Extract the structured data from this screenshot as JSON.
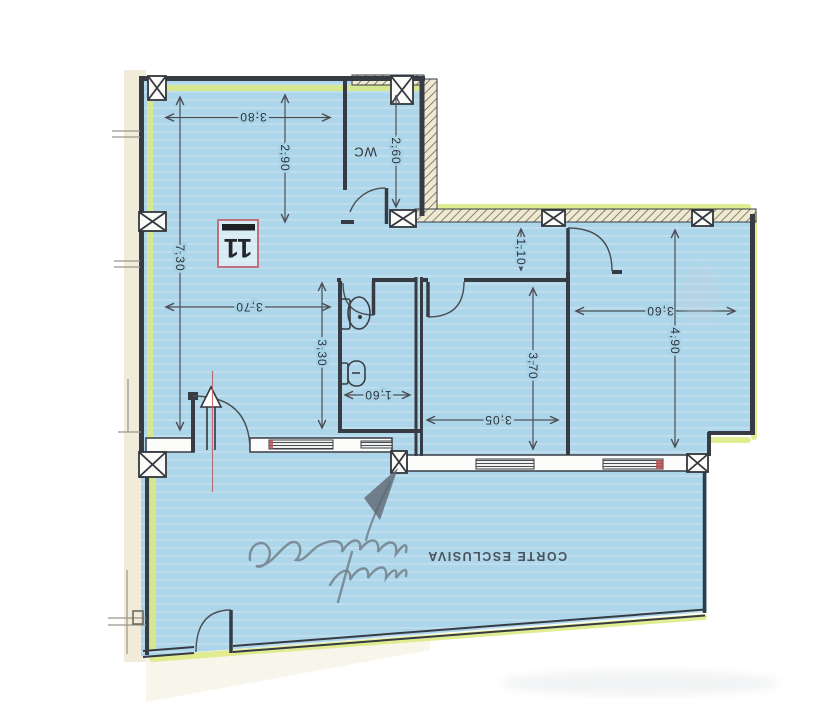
{
  "plan": {
    "unit_number": "11",
    "labels": {
      "wc": "WC",
      "courtyard": "CORTE ESCLUSIVA"
    },
    "dimensions": {
      "hall_width_top": "3,80",
      "hall_upper_height": "2,90",
      "wc_height": "2,60",
      "hall_full_height": "7,30",
      "hall_width_mid": "3,70",
      "bathroom_height": "3,30",
      "bathroom_width": "1,60",
      "corridor_width": "1,10",
      "bedroom_center_width": "3,05",
      "bedroom_center_height": "3,70",
      "bedroom_right_width": "3,60",
      "bedroom_right_height": "4,90"
    },
    "colors": {
      "floor_fill": "#aed6ea",
      "highlighter": "#dcea7f",
      "wall": "#363b44",
      "hatch_background": "#f0e9d2",
      "paper_margin": "#f1ecda",
      "unit_badge_border": "#c0717c",
      "red_accent": "#b5504f",
      "pencil": "#6e7a85"
    },
    "orientation_note": "180"
  }
}
